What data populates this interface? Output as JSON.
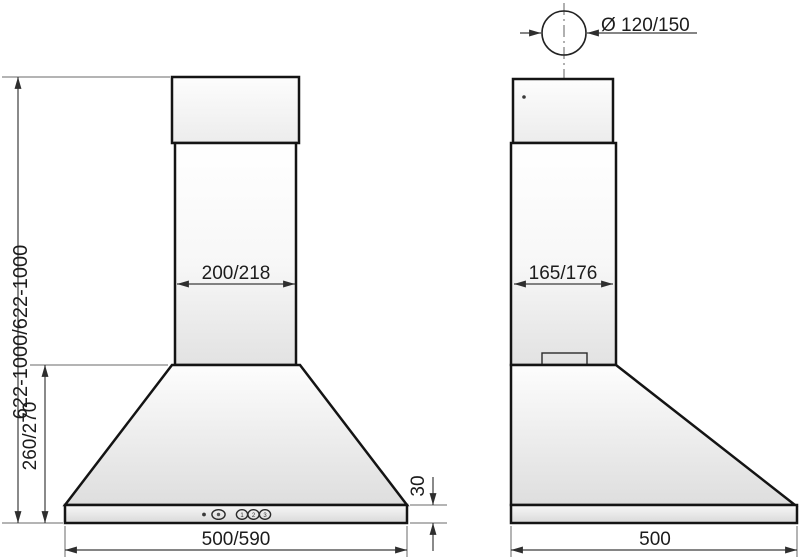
{
  "drawing": {
    "type": "cooker-hood dimensional drawing, front and side views",
    "colors": {
      "outline": "#141414",
      "dimension_lines": "#3c3c3c",
      "fill_light": "#ffffff",
      "fill_shade": "#e2e2e2"
    },
    "front_view": {
      "height_range_label": "622-1000/622-1000",
      "canopy_height_label": "260/270",
      "chimney_width_label": "200/218",
      "base_height_label": "30",
      "overall_width_label": "500/590",
      "controls": {
        "led_indicator": "power-led",
        "light_button": "light",
        "speed_buttons": [
          "1",
          "2",
          "3"
        ]
      }
    },
    "side_view": {
      "duct_diameter_label": "Ø 120/150",
      "chimney_depth_label": "165/176",
      "overall_depth_label": "500"
    }
  }
}
